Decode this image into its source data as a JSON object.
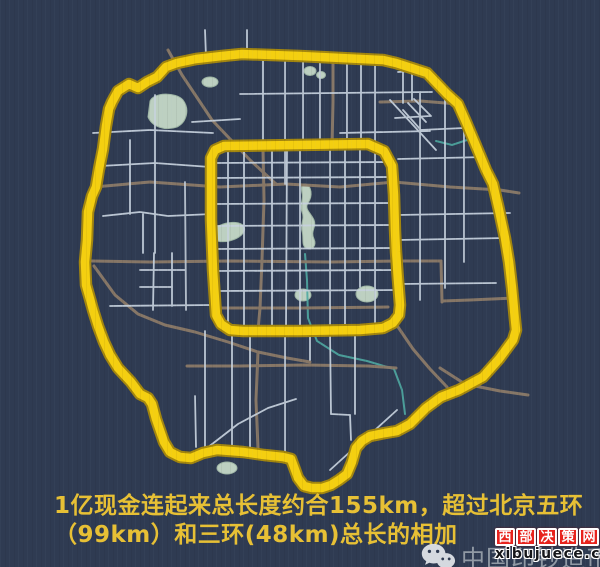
{
  "title": "北京环路现金长度对比图",
  "map": {
    "description": "stylized Beijing road map with highlighted ring roads",
    "colors": {
      "background": "#2f3b52",
      "ring_highlight": "#f4cf10",
      "ring_casing": "#a3860e",
      "major_road": "#8b7a68",
      "minor_road": "#c7d2de",
      "water": "#4fa9a1",
      "park": "#bdd0c1"
    }
  },
  "caption": {
    "line1": "1亿现金连起来总长度约合155km，超过北京五环",
    "line2": "（99km）和三环(48km)总长的相加",
    "text_color": "#e7c035"
  },
  "watermark": {
    "icon": "wechat-icon",
    "brand": "中国印钞造币"
  },
  "badge": {
    "site_name": "西部决策网",
    "chars": [
      "西",
      "部",
      "决",
      "策",
      "网"
    ],
    "domain": "xibujuece.com",
    "bg_color": "#e8231d"
  }
}
